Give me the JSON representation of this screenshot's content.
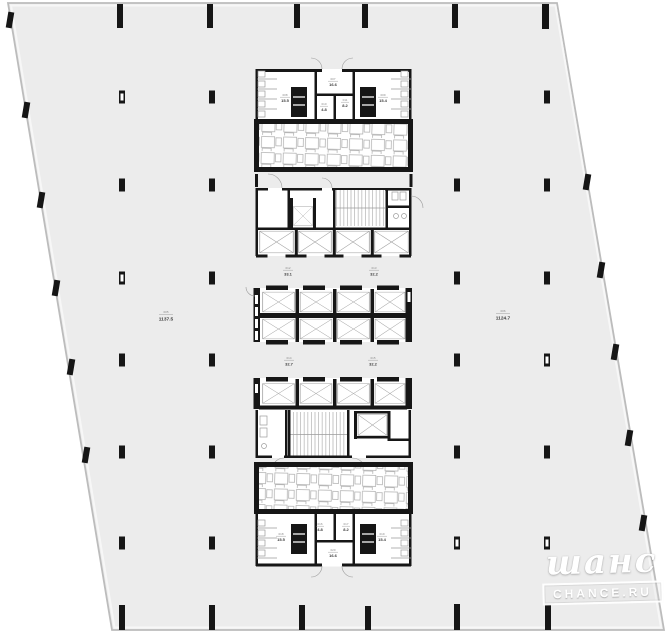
{
  "colors": {
    "bg": "#ffffff",
    "floor": "#ececec",
    "outline": "#bcbcbc",
    "wall": "#161616",
    "detail": "#9b9b9b",
    "labelDark": "#3a3a3a",
    "labelLight": "#8a8a8a"
  },
  "rooms": [
    {
      "id": "top-left",
      "code": "008",
      "area": "15.5"
    },
    {
      "id": "top-center",
      "code": "007",
      "area": "16.6"
    },
    {
      "id": "top-right",
      "code": "009",
      "area": "15.4"
    },
    {
      "id": "top-small-left",
      "code": "010",
      "area": "4.8"
    },
    {
      "id": "top-small-right",
      "code": "011",
      "area": "8.2"
    },
    {
      "id": "lift-lobby-upper-left",
      "code": "012",
      "area": "33.1"
    },
    {
      "id": "lift-lobby-upper-right",
      "code": "013",
      "area": "32.2"
    },
    {
      "id": "lift-lobby-lower-left",
      "code": "014",
      "area": "32.7"
    },
    {
      "id": "lift-lobby-lower-right",
      "code": "015",
      "area": "32.2"
    },
    {
      "id": "office-zone-left",
      "code": "005",
      "area": "1137.5"
    },
    {
      "id": "office-zone-right",
      "code": "006",
      "area": "1124.7"
    },
    {
      "id": "bottom-small-left",
      "code": "016",
      "area": "4.8"
    },
    {
      "id": "bottom-small-right",
      "code": "017",
      "area": "8.2"
    },
    {
      "id": "bottom-left",
      "code": "018",
      "area": "15.5"
    },
    {
      "id": "bottom-right",
      "code": "019",
      "area": "15.4"
    },
    {
      "id": "bottom-center",
      "code": "020",
      "area": "16.6"
    }
  ],
  "watermark": {
    "script": "шанс",
    "caption": "CHANCE.RU"
  }
}
